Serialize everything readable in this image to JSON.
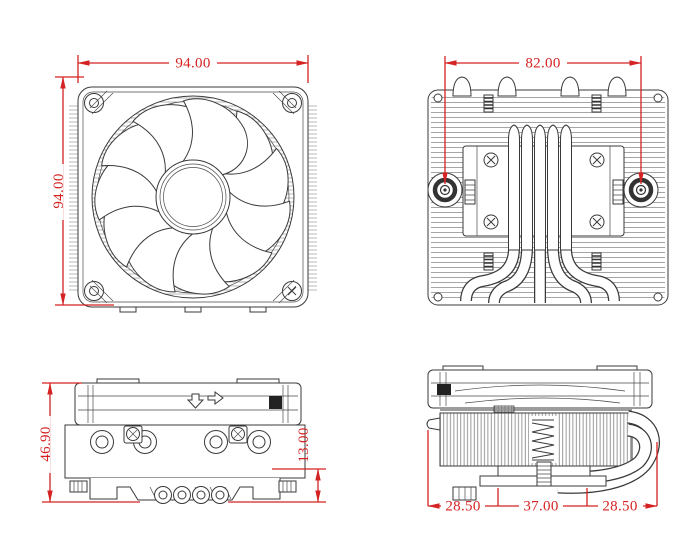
{
  "drawing": {
    "views": {
      "fan_front": {
        "width": "94.00",
        "height": "94.00"
      },
      "heatsink_top": {
        "mount_hole_spacing": "82.00"
      },
      "side": {
        "total_height": "46.90",
        "base_height": "13.00"
      },
      "profile": {
        "left_overhang": "28.50",
        "center_width": "37.00",
        "right_overhang": "28.50"
      }
    },
    "colors": {
      "dimension_red": "#d42322",
      "line_gray": "#3a3a3a"
    }
  }
}
